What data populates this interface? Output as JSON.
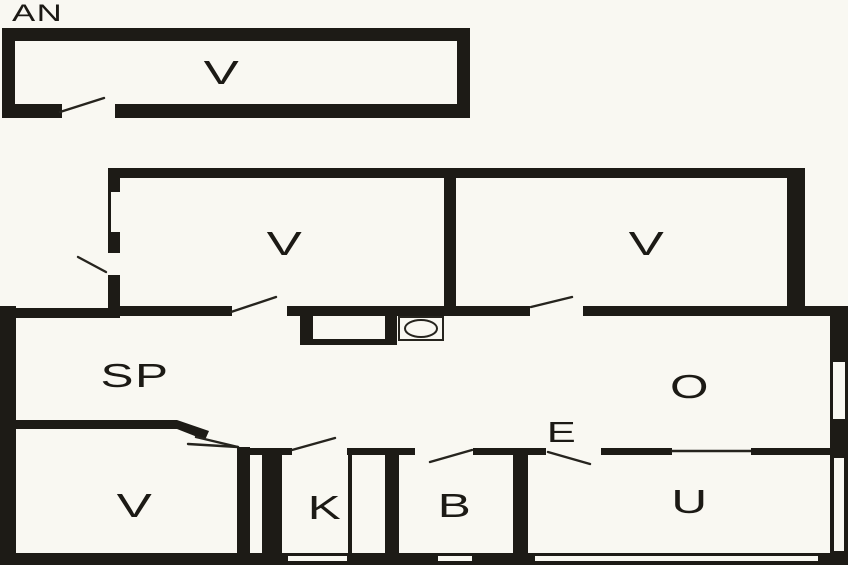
{
  "document": {
    "kind": "floor-plan",
    "description": "Black-and-white architectural floor plan of a house with detached annex"
  },
  "colors": {
    "wall": "#1d1b16",
    "floor": "#f9f8f2",
    "line": "#26241e"
  },
  "labels": {
    "annex": "AN",
    "annex_room": "V",
    "bedroom_left": "V",
    "bedroom_right": "V",
    "sp_room": "SP",
    "o_room": "O",
    "entry": "E",
    "bedroom_lower": "V",
    "kitchen": "K",
    "bathroom": "B",
    "utility": "U"
  }
}
